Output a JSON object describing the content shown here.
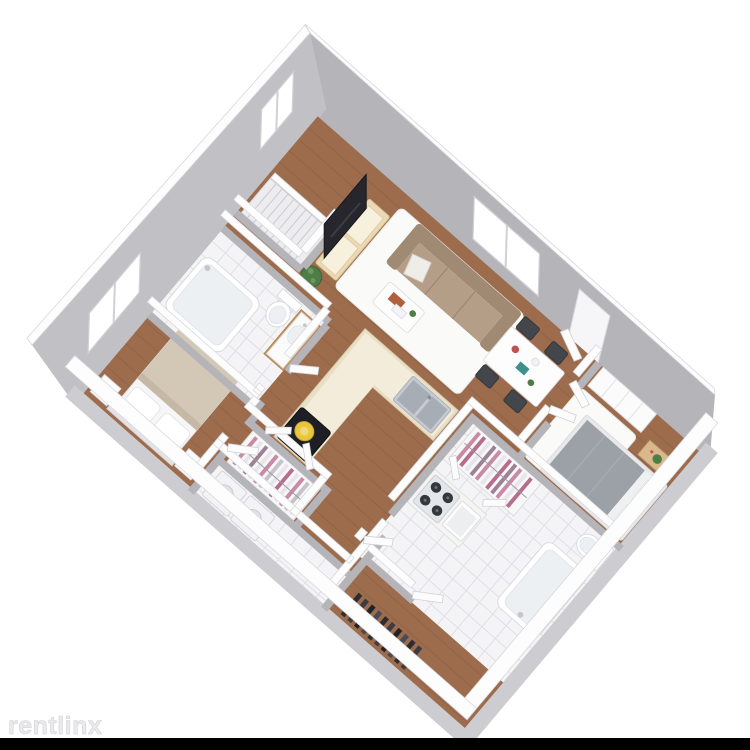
{
  "watermark": {
    "text": "rentlinx"
  },
  "palette": {
    "bg": "#ffffff",
    "black_bar": "#000000",
    "wall_face": "#b5b4b9",
    "wall_face2": "#c1c0c5",
    "wall_face_light": "#cdcdd1",
    "wall_top": "#fdfdfe",
    "wall_edge": "#d7d7db",
    "wood": "#9c6c4d",
    "wood_dark": "#7e5236",
    "tile": "#f4f4f6",
    "grout": "#dfdfe4",
    "rug": "#fafaf8",
    "sofa": "#b59e87",
    "sofa_dark": "#a18a73",
    "cabinet": "#e9dfc6",
    "cabinet_face": "#f3ecda",
    "counter_white": "#f4f4f2",
    "steel": "#c7cad0",
    "steel_dark": "#a7adb5",
    "tv": "#26262c",
    "chair": "#43464b",
    "table_white": "#fdfdfd",
    "bed_white": "#f6f6f7",
    "blanket_beige": "#d3c8b6",
    "blanket_gray": "#9ba1a7",
    "wood_furn": "#d9b98c",
    "vanity_wood": "#c89a66",
    "plant": "#4f7d46",
    "pot_yellow": "#e9c63b",
    "clothes_pink": "#c98ba4",
    "clothes_rose": "#b76e8e",
    "clothes_mauve": "#9d8296",
    "clothes_light": "#e8e6ea",
    "clothes_dark": "#2e2e33",
    "appliance": "#f3f3f5",
    "watermark": "#eaeaec",
    "watermark_edge": "#d2d2d6"
  },
  "floor_plan": {
    "type": "3d-isometric-floor-plan",
    "unit_summary": "2 bedroom, 2 bathroom apartment with open living/dining, L-shaped kitchen, walk-in closets and laundry",
    "rooms": [
      {
        "name": "living-room",
        "floor": "hardwood",
        "contents": [
          "sofa",
          "area-rug",
          "coffee-table",
          "tv-console",
          "tv",
          "plant",
          "stairs"
        ]
      },
      {
        "name": "dining-area",
        "floor": "hardwood",
        "contents": [
          "dining-table",
          "four-chairs",
          "window",
          "entry-door"
        ]
      },
      {
        "name": "kitchen",
        "floor": "hardwood",
        "contents": [
          "l-shaped-counter",
          "double-steel-sink",
          "cooktop-with-yellow-pot",
          "gas-range",
          "white-sink"
        ]
      },
      {
        "name": "bedroom-1",
        "floor": "hardwood",
        "contents": [
          "double-bed",
          "two-nightstands",
          "lamps",
          "window"
        ]
      },
      {
        "name": "bathroom-1",
        "floor": "tile",
        "contents": [
          "bathtub",
          "toilet",
          "wood-vanity-sink"
        ]
      },
      {
        "name": "bedroom-2",
        "floor": "hardwood",
        "contents": [
          "double-bed-gray",
          "nightstand-plant",
          "wardrobe",
          "area-rug"
        ]
      },
      {
        "name": "bathroom-2",
        "floor": "tile",
        "contents": [
          "bathtub",
          "toilet"
        ]
      },
      {
        "name": "walk-in-closet",
        "floor": "hardwood",
        "contents": [
          "hanging-clothes-pink-white"
        ]
      },
      {
        "name": "closet-2",
        "floor": "hardwood",
        "contents": [
          "hanging-clothes-pink"
        ]
      },
      {
        "name": "laundry-room",
        "floor": "tile",
        "contents": [
          "washer",
          "dryer"
        ]
      },
      {
        "name": "entry-hall",
        "floor": "hardwood",
        "contents": [
          "coat-rack-dark-clothes"
        ]
      }
    ]
  }
}
